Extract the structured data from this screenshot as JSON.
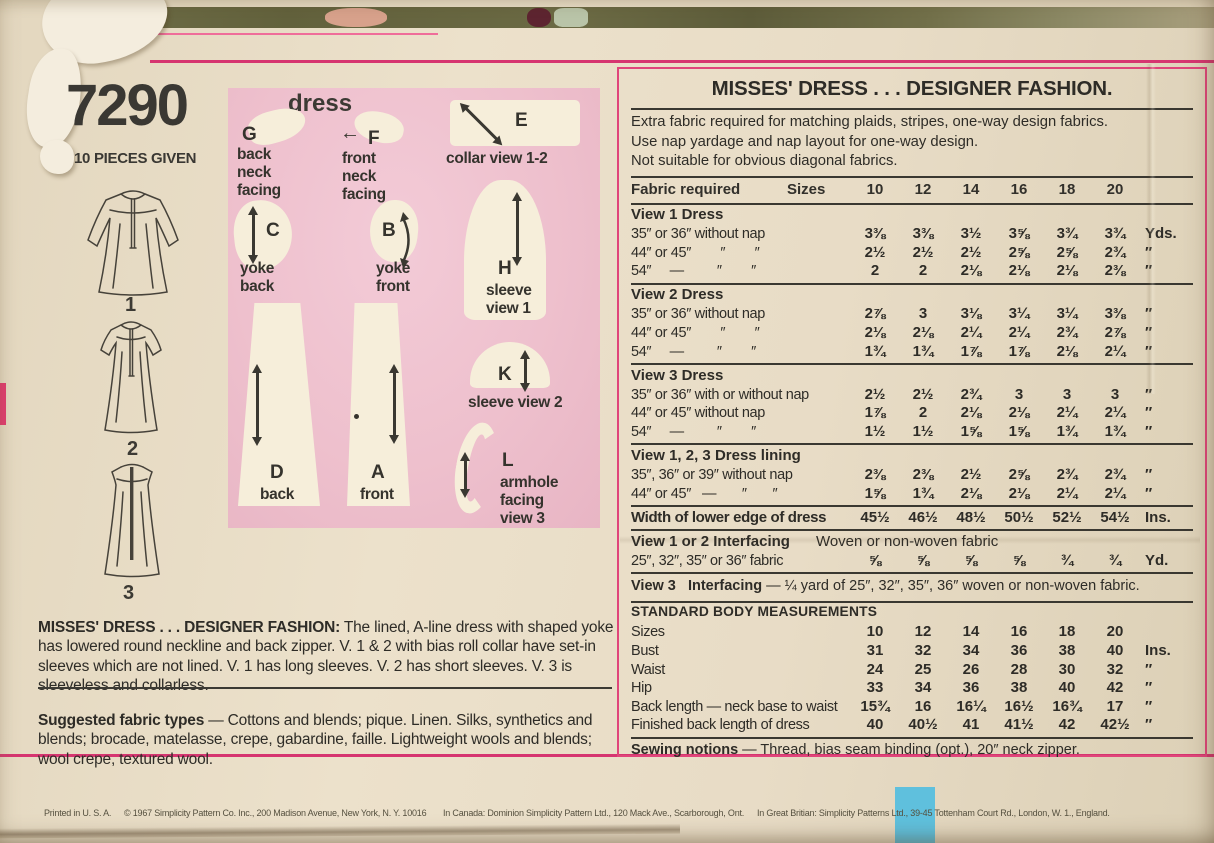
{
  "header": {
    "pattern_number": "7290",
    "pieces_given": "10 PIECES GIVEN"
  },
  "diagram": {
    "title": "dress",
    "pieces": [
      {
        "letter": "G",
        "label": "back\nneck\nfacing"
      },
      {
        "letter": "F",
        "label": "front\nneck\nfacing"
      },
      {
        "letter": "E",
        "label": "collar view 1-2"
      },
      {
        "letter": "C",
        "label": "yoke\nback"
      },
      {
        "letter": "B",
        "label": "yoke\nfront"
      },
      {
        "letter": "H",
        "label": "sleeve\nview 1"
      },
      {
        "letter": "K",
        "label": "sleeve view 2"
      },
      {
        "letter": "L",
        "label": "armhole\nfacing\nview 3"
      },
      {
        "letter": "D",
        "label": "back"
      },
      {
        "letter": "A",
        "label": "front"
      }
    ]
  },
  "icons": {
    "front_neck_arrow": "←"
  },
  "views": [
    {
      "label": "1"
    },
    {
      "label": "2"
    },
    {
      "label": "3"
    }
  ],
  "description": {
    "lead": "MISSES' DRESS . . . DESIGNER FASHION:",
    "body": " The lined, A-line dress with shaped yoke has lowered round neckline and back zipper. V. 1 & 2 with bias roll collar have set-in sleeves which are not lined. V. 1 has long sleeves. V. 2 has short sleeves. V. 3 is sleeveless and collarless."
  },
  "suggested_fabrics": {
    "lead": "Suggested fabric types",
    "body": " — Cottons and blends; pique. Linen. Silks, synthetics and blends; brocade, matelasse, crepe, gabardine, faille. Lightweight wools and blends; wool crepe, textured wool."
  },
  "fabric_panel": {
    "title": "MISSES' DRESS . . . DESIGNER FASHION.",
    "notes": [
      "Extra fabric required for matching plaids, stripes, one-way design fabrics.",
      "Use nap yardage and nap layout for one-way design.",
      "Not suitable for obvious diagonal fabrics."
    ],
    "columns": {
      "label": "Fabric required",
      "sizes_label": "Sizes",
      "sizes": [
        "10",
        "12",
        "14",
        "16",
        "18",
        "20"
      ]
    },
    "sections": [
      {
        "heading": "View 1   Dress",
        "rows": [
          {
            "label": "35″ or 36″ without nap",
            "values": [
              "3⅜",
              "3⅜",
              "3½",
              "3⅝",
              "3¾",
              "3¾"
            ],
            "unit": "Yds."
          },
          {
            "label": "44″ or 45″        ″        ″",
            "values": [
              "2½",
              "2½",
              "2½",
              "2⅝",
              "2⅝",
              "2¾"
            ],
            "unit": "″"
          },
          {
            "label": "54″     —         ″        ″",
            "values": [
              "2",
              "2",
              "2⅛",
              "2⅛",
              "2⅛",
              "2⅜"
            ],
            "unit": "″"
          }
        ]
      },
      {
        "heading": "View 2   Dress",
        "rows": [
          {
            "label": "35″ or 36″ without nap",
            "values": [
              "2⅞",
              "3",
              "3⅛",
              "3¼",
              "3¼",
              "3⅜"
            ],
            "unit": "″"
          },
          {
            "label": "44″ or 45″        ″        ″",
            "values": [
              "2⅛",
              "2⅛",
              "2¼",
              "2¼",
              "2¾",
              "2⅞"
            ],
            "unit": "″"
          },
          {
            "label": "54″     —         ″        ″",
            "values": [
              "1¾",
              "1¾",
              "1⅞",
              "1⅞",
              "2⅛",
              "2¼"
            ],
            "unit": "″"
          }
        ]
      },
      {
        "heading": "View 3   Dress",
        "rows": [
          {
            "label": "35″ or 36″ with or without nap",
            "values": [
              "2½",
              "2½",
              "2¾",
              "3",
              "3",
              "3"
            ],
            "unit": "″"
          },
          {
            "label": "44″ or 45″ without nap",
            "values": [
              "1⅞",
              "2",
              "2⅛",
              "2⅛",
              "2¼",
              "2¼"
            ],
            "unit": "″"
          },
          {
            "label": "54″     —         ″        ″",
            "values": [
              "1½",
              "1½",
              "1⅝",
              "1⅝",
              "1¾",
              "1¾"
            ],
            "unit": "″"
          }
        ]
      },
      {
        "heading": "View 1, 2, 3   Dress lining",
        "rows": [
          {
            "label": "35″, 36″ or 39″ without nap",
            "values": [
              "2⅜",
              "2⅜",
              "2½",
              "2⅝",
              "2¾",
              "2¾"
            ],
            "unit": "″"
          },
          {
            "label": "44″ or 45″   —       ″       ″",
            "values": [
              "1⅝",
              "1¾",
              "2⅛",
              "2⅛",
              "2¼",
              "2¼"
            ],
            "unit": "″"
          }
        ]
      },
      {
        "rows": [
          {
            "label": "Width of lower edge of dress",
            "bold": true,
            "values": [
              "45½",
              "46½",
              "48½",
              "50½",
              "52½",
              "54½"
            ],
            "unit": "Ins."
          }
        ]
      },
      {
        "heading": "View 1 or 2   Interfacing",
        "heading_note": "Woven or non-woven fabric",
        "rows": [
          {
            "label": "25″, 32″, 35″ or 36″ fabric",
            "values": [
              "⅝",
              "⅝",
              "⅝",
              "⅝",
              "¾",
              "¾"
            ],
            "unit": "Yd."
          }
        ]
      },
      {
        "type": "text",
        "lead": "View 3   Interfacing",
        "text": " — ¼ yard of 25″, 32″, 35″, 36″ woven or non-woven fabric."
      },
      {
        "heading": "STANDARD BODY MEASUREMENTS",
        "small_heading": true,
        "rows": [
          {
            "label": "Sizes",
            "values": [
              "10",
              "12",
              "14",
              "16",
              "18",
              "20"
            ],
            "unit": ""
          },
          {
            "label": "Bust",
            "values": [
              "31",
              "32",
              "34",
              "36",
              "38",
              "40"
            ],
            "unit": "Ins."
          },
          {
            "label": "Waist",
            "values": [
              "24",
              "25",
              "26",
              "28",
              "30",
              "32"
            ],
            "unit": "″"
          },
          {
            "label": "Hip",
            "values": [
              "33",
              "34",
              "36",
              "38",
              "40",
              "42"
            ],
            "unit": "″"
          },
          {
            "label": "Back length — neck base to waist",
            "values": [
              "15¾",
              "16",
              "16¼",
              "16½",
              "16¾",
              "17"
            ],
            "unit": "″"
          },
          {
            "label": "Finished back length of dress",
            "values": [
              "40",
              "40½",
              "41",
              "41½",
              "42",
              "42½"
            ],
            "unit": "″"
          }
        ]
      },
      {
        "type": "text",
        "lead": "Sewing notions",
        "text": " — Thread, bias seam binding (opt.), 20″ neck zipper."
      }
    ]
  },
  "footer": {
    "items": [
      "Printed in U. S. A.",
      "© 1967 Simplicity Pattern Co. Inc., 200 Madison Avenue, New York, N. Y. 10016",
      "In Canada:  Dominion Simplicity Pattern Ltd., 120 Mack Ave., Scarborough, Ont.",
      "In Great Britian: Simplicity Patterns Ltd., 39-45 Tottenham Court Rd., London, W. 1., England."
    ]
  },
  "colors": {
    "accent_magenta": "#d63570",
    "pink_box": "#eec0cd",
    "paper": "#e8dcc6",
    "blue_printer_mark": "#5fc0dd",
    "ink": "#32302b"
  }
}
